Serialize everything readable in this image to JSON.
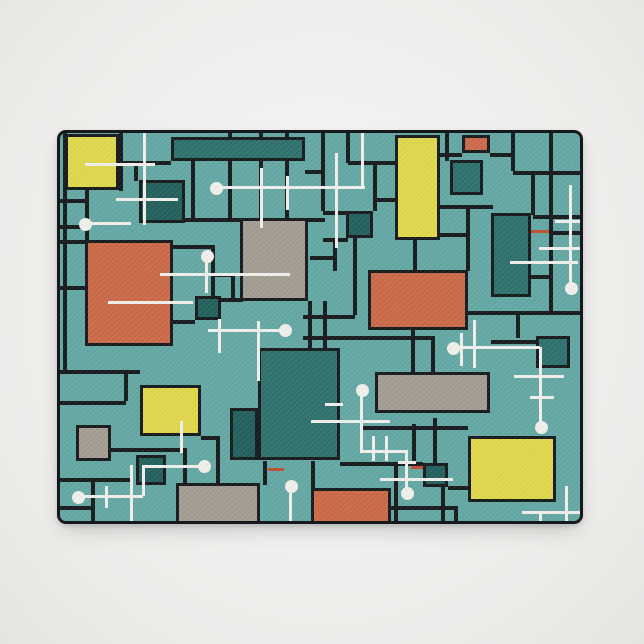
{
  "meta": {
    "product_type": "doormat",
    "style": "mid-century modern abstract grid pattern with atomic-era sputnik lines",
    "background": "light studio backdrop"
  },
  "palette": {
    "page_bg": "#f0efed",
    "teal_bg": "#64a9a5",
    "teal_dark": "#2d716d",
    "teal_deep": "#22605d",
    "orange": "#cd6a49",
    "yellow": "#e2da4b",
    "gray": "#a59e94",
    "black": "#16191b",
    "white": "#f3f2ee",
    "red_accent": "#c0502f"
  },
  "mat": {
    "x": 57,
    "y": 130,
    "w": 526,
    "h": 394
  },
  "pattern": {
    "rects": [
      {
        "x": 5,
        "y": 1,
        "w": 54,
        "h": 56,
        "color": "yellow"
      },
      {
        "x": 111,
        "y": 4,
        "w": 134,
        "h": 24,
        "color": "teal_dark"
      },
      {
        "x": 402,
        "y": 2,
        "w": 28,
        "h": 18,
        "color": "orange"
      },
      {
        "x": 335,
        "y": 2,
        "w": 45,
        "h": 105,
        "color": "yellow"
      },
      {
        "x": 390,
        "y": 27,
        "w": 33,
        "h": 35,
        "color": "teal_dark"
      },
      {
        "x": 79,
        "y": 47,
        "w": 46,
        "h": 43,
        "color": "teal_deep"
      },
      {
        "x": 180,
        "y": 85,
        "w": 68,
        "h": 83,
        "color": "gray"
      },
      {
        "x": 286,
        "y": 78,
        "w": 27,
        "h": 27,
        "color": "teal_deep"
      },
      {
        "x": 431,
        "y": 80,
        "w": 40,
        "h": 84,
        "color": "teal_dark"
      },
      {
        "x": 25,
        "y": 107,
        "w": 88,
        "h": 106,
        "color": "orange"
      },
      {
        "x": 135,
        "y": 163,
        "w": 26,
        "h": 24,
        "color": "teal_deep"
      },
      {
        "x": 308,
        "y": 137,
        "w": 100,
        "h": 60,
        "color": "orange"
      },
      {
        "x": 198,
        "y": 215,
        "w": 82,
        "h": 112,
        "color": "teal_dark"
      },
      {
        "x": 315,
        "y": 239,
        "w": 115,
        "h": 41,
        "color": "gray"
      },
      {
        "x": 476,
        "y": 203,
        "w": 34,
        "h": 32,
        "color": "teal_dark"
      },
      {
        "x": 80,
        "y": 252,
        "w": 61,
        "h": 51,
        "color": "yellow"
      },
      {
        "x": 16,
        "y": 292,
        "w": 35,
        "h": 36,
        "color": "gray"
      },
      {
        "x": 76,
        "y": 322,
        "w": 30,
        "h": 30,
        "color": "teal_deep"
      },
      {
        "x": 170,
        "y": 275,
        "w": 28,
        "h": 52,
        "color": "teal_deep"
      },
      {
        "x": 116,
        "y": 350,
        "w": 84,
        "h": 44,
        "color": "gray"
      },
      {
        "x": 251,
        "y": 355,
        "w": 80,
        "h": 39,
        "color": "orange"
      },
      {
        "x": 363,
        "y": 330,
        "w": 25,
        "h": 24,
        "color": "teal_deep"
      },
      {
        "x": 408,
        "y": 303,
        "w": 88,
        "h": 66,
        "color": "yellow"
      }
    ],
    "grid": [
      [
        59,
        0,
        4,
        58
      ],
      [
        74,
        28,
        4,
        20
      ],
      [
        3,
        0,
        4,
        237
      ],
      [
        25,
        57,
        4,
        53
      ],
      [
        131,
        28,
        4,
        57
      ],
      [
        168,
        0,
        4,
        85
      ],
      [
        151,
        112,
        4,
        75
      ],
      [
        199,
        0,
        4,
        85
      ],
      [
        225,
        0,
        4,
        85
      ],
      [
        261,
        0,
        4,
        78
      ],
      [
        286,
        0,
        4,
        30
      ],
      [
        313,
        28,
        4,
        50
      ],
      [
        273,
        105,
        4,
        33
      ],
      [
        353,
        107,
        4,
        31
      ],
      [
        385,
        0,
        4,
        28
      ],
      [
        451,
        0,
        4,
        38
      ],
      [
        489,
        0,
        4,
        178
      ],
      [
        406,
        72,
        4,
        66
      ],
      [
        471,
        38,
        4,
        44
      ],
      [
        456,
        178,
        4,
        27
      ],
      [
        64,
        237,
        4,
        31
      ],
      [
        31,
        345,
        4,
        49
      ],
      [
        156,
        303,
        4,
        47
      ],
      [
        123,
        315,
        4,
        35
      ],
      [
        251,
        328,
        4,
        27
      ],
      [
        334,
        332,
        4,
        62
      ],
      [
        381,
        353,
        4,
        41
      ],
      [
        394,
        373,
        4,
        21
      ],
      [
        352,
        291,
        4,
        41
      ],
      [
        373,
        285,
        4,
        46
      ],
      [
        293,
        105,
        4,
        77
      ],
      [
        248,
        168,
        4,
        47
      ],
      [
        263,
        168,
        4,
        47
      ],
      [
        351,
        193,
        4,
        47
      ],
      [
        371,
        203,
        4,
        36
      ],
      [
        171,
        140,
        4,
        25
      ],
      [
        203,
        328,
        4,
        24
      ],
      [
        61,
        28,
        50,
        4
      ],
      [
        245,
        37,
        18,
        4
      ],
      [
        288,
        28,
        47,
        4
      ],
      [
        315,
        65,
        20,
        4
      ],
      [
        125,
        85,
        58,
        4
      ],
      [
        248,
        85,
        17,
        4
      ],
      [
        263,
        78,
        23,
        4
      ],
      [
        263,
        105,
        25,
        4
      ],
      [
        250,
        123,
        27,
        4
      ],
      [
        0,
        66,
        28,
        4
      ],
      [
        0,
        92,
        28,
        4
      ],
      [
        0,
        107,
        25,
        4
      ],
      [
        113,
        112,
        41,
        4
      ],
      [
        380,
        20,
        22,
        4
      ],
      [
        430,
        20,
        25,
        4
      ],
      [
        453,
        38,
        73,
        4
      ],
      [
        380,
        72,
        53,
        4
      ],
      [
        380,
        100,
        28,
        4
      ],
      [
        473,
        82,
        53,
        4
      ],
      [
        491,
        98,
        35,
        4
      ],
      [
        471,
        142,
        21,
        4
      ],
      [
        408,
        178,
        118,
        4
      ],
      [
        431,
        207,
        45,
        4
      ],
      [
        0,
        153,
        25,
        4
      ],
      [
        0,
        237,
        80,
        4
      ],
      [
        0,
        268,
        66,
        4
      ],
      [
        51,
        315,
        74,
        4
      ],
      [
        0,
        345,
        73,
        4
      ],
      [
        0,
        373,
        33,
        4
      ],
      [
        141,
        303,
        19,
        4
      ],
      [
        280,
        329,
        83,
        4
      ],
      [
        301,
        293,
        107,
        4
      ],
      [
        388,
        353,
        20,
        4
      ],
      [
        331,
        373,
        65,
        4
      ],
      [
        243,
        182,
        52,
        4
      ],
      [
        243,
        203,
        132,
        4
      ],
      [
        113,
        187,
        22,
        4
      ],
      [
        161,
        165,
        22,
        4
      ],
      [
        153,
        140,
        22,
        4
      ]
    ],
    "accents": [
      [
        471,
        97,
        18,
        3
      ],
      [
        351,
        333,
        12,
        3
      ],
      [
        208,
        335,
        16,
        3
      ]
    ],
    "lines": [
      [
        83,
        0,
        3,
        92
      ],
      [
        25,
        30,
        70,
        3
      ],
      [
        56,
        65,
        62,
        3
      ],
      [
        24,
        89,
        47,
        3
      ],
      [
        155,
        53,
        150,
        3
      ],
      [
        301,
        0,
        3,
        55
      ],
      [
        275,
        20,
        3,
        95
      ],
      [
        200,
        35,
        3,
        60
      ],
      [
        226,
        43,
        3,
        34
      ],
      [
        145,
        123,
        3,
        37
      ],
      [
        100,
        140,
        130,
        3
      ],
      [
        48,
        168,
        85,
        3
      ],
      [
        148,
        196,
        76,
        3
      ],
      [
        158,
        186,
        3,
        34
      ],
      [
        197,
        188,
        3,
        60
      ],
      [
        300,
        256,
        3,
        63
      ],
      [
        300,
        317,
        46,
        3
      ],
      [
        345,
        317,
        3,
        42
      ],
      [
        251,
        287,
        79,
        3
      ],
      [
        312,
        303,
        3,
        25
      ],
      [
        325,
        303,
        3,
        25
      ],
      [
        265,
        270,
        18,
        3
      ],
      [
        320,
        345,
        73,
        3
      ],
      [
        338,
        328,
        18,
        3
      ],
      [
        392,
        213,
        88,
        3
      ],
      [
        479,
        214,
        3,
        79
      ],
      [
        400,
        200,
        3,
        33
      ],
      [
        413,
        187,
        3,
        48
      ],
      [
        454,
        242,
        50,
        3
      ],
      [
        470,
        263,
        24,
        3
      ],
      [
        509,
        52,
        3,
        100
      ],
      [
        495,
        87,
        28,
        3
      ],
      [
        479,
        114,
        44,
        3
      ],
      [
        450,
        128,
        68,
        3
      ],
      [
        462,
        378,
        61,
        3
      ],
      [
        479,
        378,
        3,
        16
      ],
      [
        505,
        353,
        3,
        40
      ],
      [
        229,
        352,
        3,
        41
      ],
      [
        180,
        388,
        110,
        3
      ],
      [
        17,
        362,
        66,
        3
      ],
      [
        82,
        332,
        3,
        31
      ],
      [
        82,
        332,
        60,
        3
      ],
      [
        45,
        353,
        3,
        22
      ],
      [
        70,
        332,
        3,
        60
      ],
      [
        120,
        288,
        3,
        32
      ]
    ],
    "dots": [
      [
        24,
        90
      ],
      [
        155,
        54
      ],
      [
        146,
        122
      ],
      [
        224,
        196
      ],
      [
        301,
        256
      ],
      [
        346,
        359
      ],
      [
        392,
        214
      ],
      [
        480,
        293
      ],
      [
        510,
        154
      ],
      [
        17,
        363
      ],
      [
        143,
        332
      ],
      [
        230,
        352
      ]
    ],
    "dot_diameter": 13
  }
}
